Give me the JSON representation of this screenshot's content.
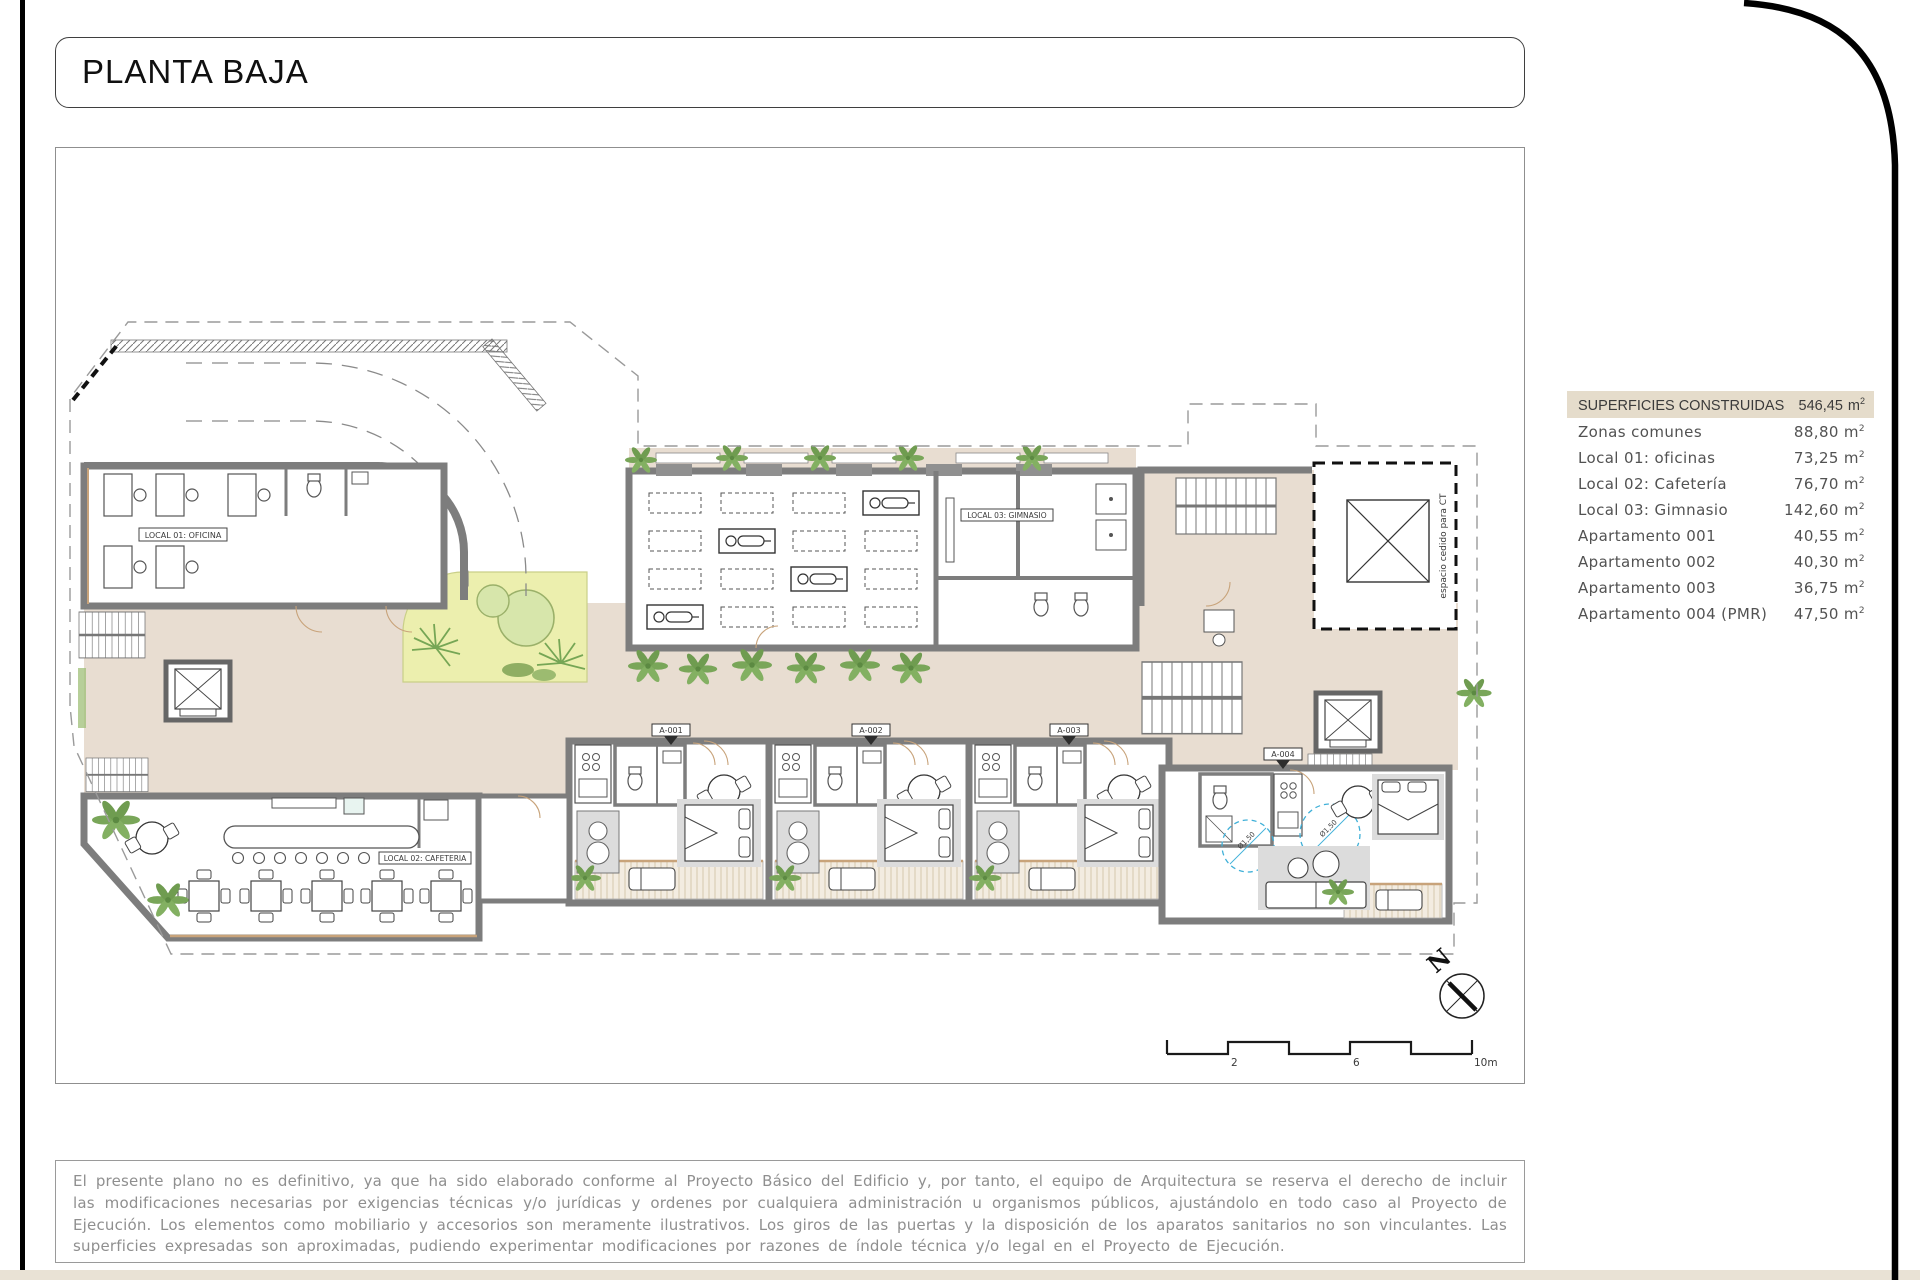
{
  "page": {
    "title": "PLANTA BAJA"
  },
  "surfaces": {
    "header": {
      "label": "SUPERFICIES CONSTRUIDAS",
      "value": "546,45"
    },
    "unit_base": "m",
    "unit_exp": "2",
    "rows": [
      {
        "label": "Zonas comunes",
        "value": "88,80"
      },
      {
        "label": "Local 01: oficinas",
        "value": "73,25"
      },
      {
        "label": "Local 02: Cafetería",
        "value": "76,70"
      },
      {
        "label": "Local 03: Gimnasio",
        "value": "142,60"
      },
      {
        "label": "Apartamento 001",
        "value": "40,55"
      },
      {
        "label": "Apartamento 002",
        "value": "40,30"
      },
      {
        "label": "Apartamento 003",
        "value": "36,75"
      },
      {
        "label": "Apartamento 004 (PMR)",
        "value": "47,50"
      }
    ]
  },
  "plan": {
    "room_labels": {
      "local01": "LOCAL 01: OFICINA",
      "local02": "LOCAL 02: CAFETERIA",
      "local03": "LOCAL 03: GIMNASIO",
      "ct": "espacio cedido para CT"
    },
    "apartment_tags": [
      "A-001",
      "A-002",
      "A-003",
      "A-004"
    ],
    "accessibility_radius": "Ø1,50",
    "north_label": "N",
    "scale": {
      "t1": "2",
      "t2": "6",
      "t3": "10m"
    }
  },
  "disclaimer": "El presente plano no es definitivo, ya que ha sido elaborado conforme al Proyecto Básico del Edificio y, por tanto, el equipo de Arquitectura se reserva el derecho de incluir las modificaciones necesarias por exigencias técnicas y/o jurídicas y ordenes por cualquiera administración u organismos públicos, ajustándolo en todo caso al Proyecto de Ejecución. Los elementos como mobiliario y accesorios son meramente ilustrativos. Los giros de las puertas y la disposición de los aparatos sanitarios no son vinculantes. Las superficies expresadas son aproximadas, pudiendo experimentar modificaciones por razones de índole técnica y/o legal en el Proyecto de Ejecución.",
  "colors": {
    "wall": "#7d7d7d",
    "corridor": "#e8ddd1",
    "garden": "#ecefae",
    "plant": "#79a659",
    "wood": "#c8a37a",
    "accessible_blue": "#3fb0d8",
    "table_header_bg": "#e5dccb"
  }
}
